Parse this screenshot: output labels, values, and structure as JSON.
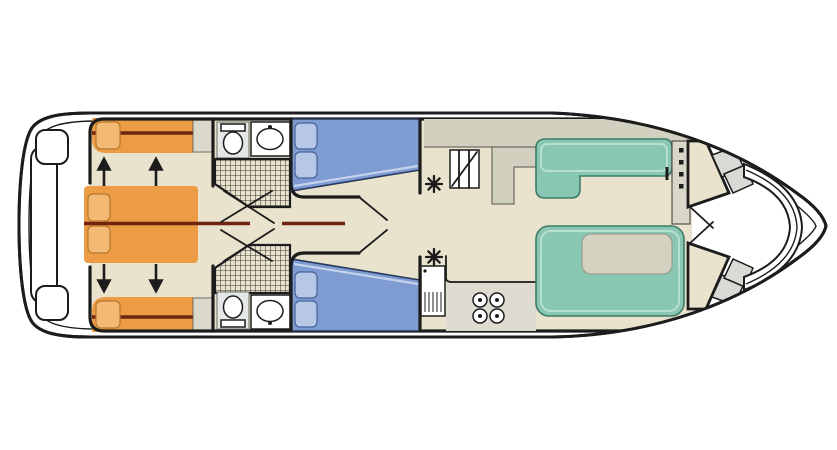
{
  "diagram": {
    "type": "boat-deck-plan",
    "subject": "top-down floor plan of a river cruiser houseboat",
    "orientation": {
      "bow": "right",
      "stern": "left"
    }
  },
  "colors": {
    "line": "#1c1c1c",
    "white": "#ffffff",
    "floor": "#e9e3cd",
    "counter": "#d2d1c0",
    "counter_edge": "#55524a",
    "stove_counter": "#dedcd0",
    "shelf": "#dbd9cb",
    "bed_orange": "#ec9c45",
    "pillow_orange": "#f2ba74",
    "pillow_orange_edge": "#b5772a",
    "partition_maroon": "#6f2410",
    "bed_blue": "#7e9cd2",
    "bed_blue_edge": "#27395c",
    "bed_blue_fold": "#c5d3ec",
    "pillow_blue": "#b7c7e6",
    "pillow_blue_edge": "#44639b",
    "seat_teal": "#8ac7b3",
    "seat_teal_edge": "#3e7a69",
    "seat_teal_light": "#b7e0d3",
    "table_gray": "#d5d2c1",
    "table_edge": "#969384",
    "helm_gray": "#d8d7c9",
    "step_gray": "#d9d9d5",
    "fixture_bg": "#e3e7e6",
    "shower_hatch_line": "#3c3a34"
  },
  "features": {
    "stern_deck": {
      "name": "aft deck / swim platform",
      "elements": [
        "platform-bench",
        "side-lockers"
      ]
    },
    "aft_cabins": {
      "count": 2,
      "bed_color": "orange",
      "beds": [
        "single-berth-top",
        "convertible-double-berth-center",
        "single-berth-bottom"
      ],
      "pillows": 4,
      "conversion_arrows": [
        "up",
        "up",
        "down",
        "down"
      ]
    },
    "bathrooms": {
      "count": 2,
      "fixtures_each": [
        "toilet",
        "washbasin",
        "shower"
      ],
      "door_marks": 2
    },
    "mid_cabins": {
      "count": 2,
      "bed_color": "blue",
      "beds": [
        "double-berth-top",
        "double-berth-bottom"
      ],
      "pillows_each": 2
    },
    "galley": {
      "stove_burners": 4,
      "elements": [
        "companionway-stairs",
        "vent-top",
        "vent-bottom",
        "refrigerator",
        "worktop-counters"
      ]
    },
    "salon": {
      "seat_color": "teal",
      "benches": [
        "l-bench-top",
        "u-dinette-bottom"
      ],
      "tables": 1
    },
    "helm": {
      "instrument_dots": 4,
      "throttle_levers": 1,
      "console_color": "beige"
    },
    "bow": {
      "access_steps": 2,
      "seating": "curved-bow-bench",
      "hull_tip": "pointed"
    }
  }
}
